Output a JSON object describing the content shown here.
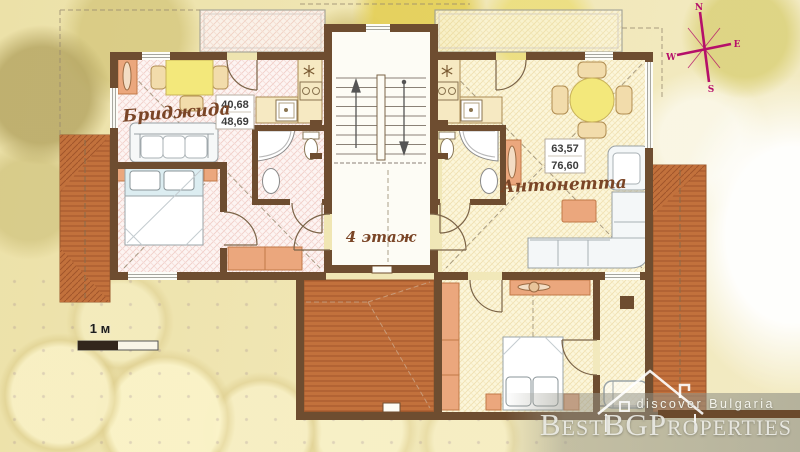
{
  "apartments": {
    "left": {
      "name": "Бриджида",
      "area_top": "40,68",
      "area_bottom": "48,69"
    },
    "right": {
      "name": "Антонетта",
      "area_top": "63,57",
      "area_bottom": "76,60"
    }
  },
  "floor": {
    "label": "4 этаж"
  },
  "scale_bar": {
    "label": "1 м"
  },
  "compass": {
    "north": "N",
    "east": "E",
    "south": "S",
    "west": "W"
  },
  "watermark": {
    "tagline": "discover Bulgaria",
    "brand": "BestBGProperties"
  },
  "colors": {
    "wall": "#6e4d30",
    "roof": "#c2713c",
    "roof_line": "#a1552b",
    "floor_left": "#fdf4f2",
    "floor_right": "#fcf6da",
    "furniture_orange": "#eba77d",
    "table_yellow": "#f3e87b",
    "compass_magenta": "#b5106a",
    "label_brown": "#7a4526"
  }
}
